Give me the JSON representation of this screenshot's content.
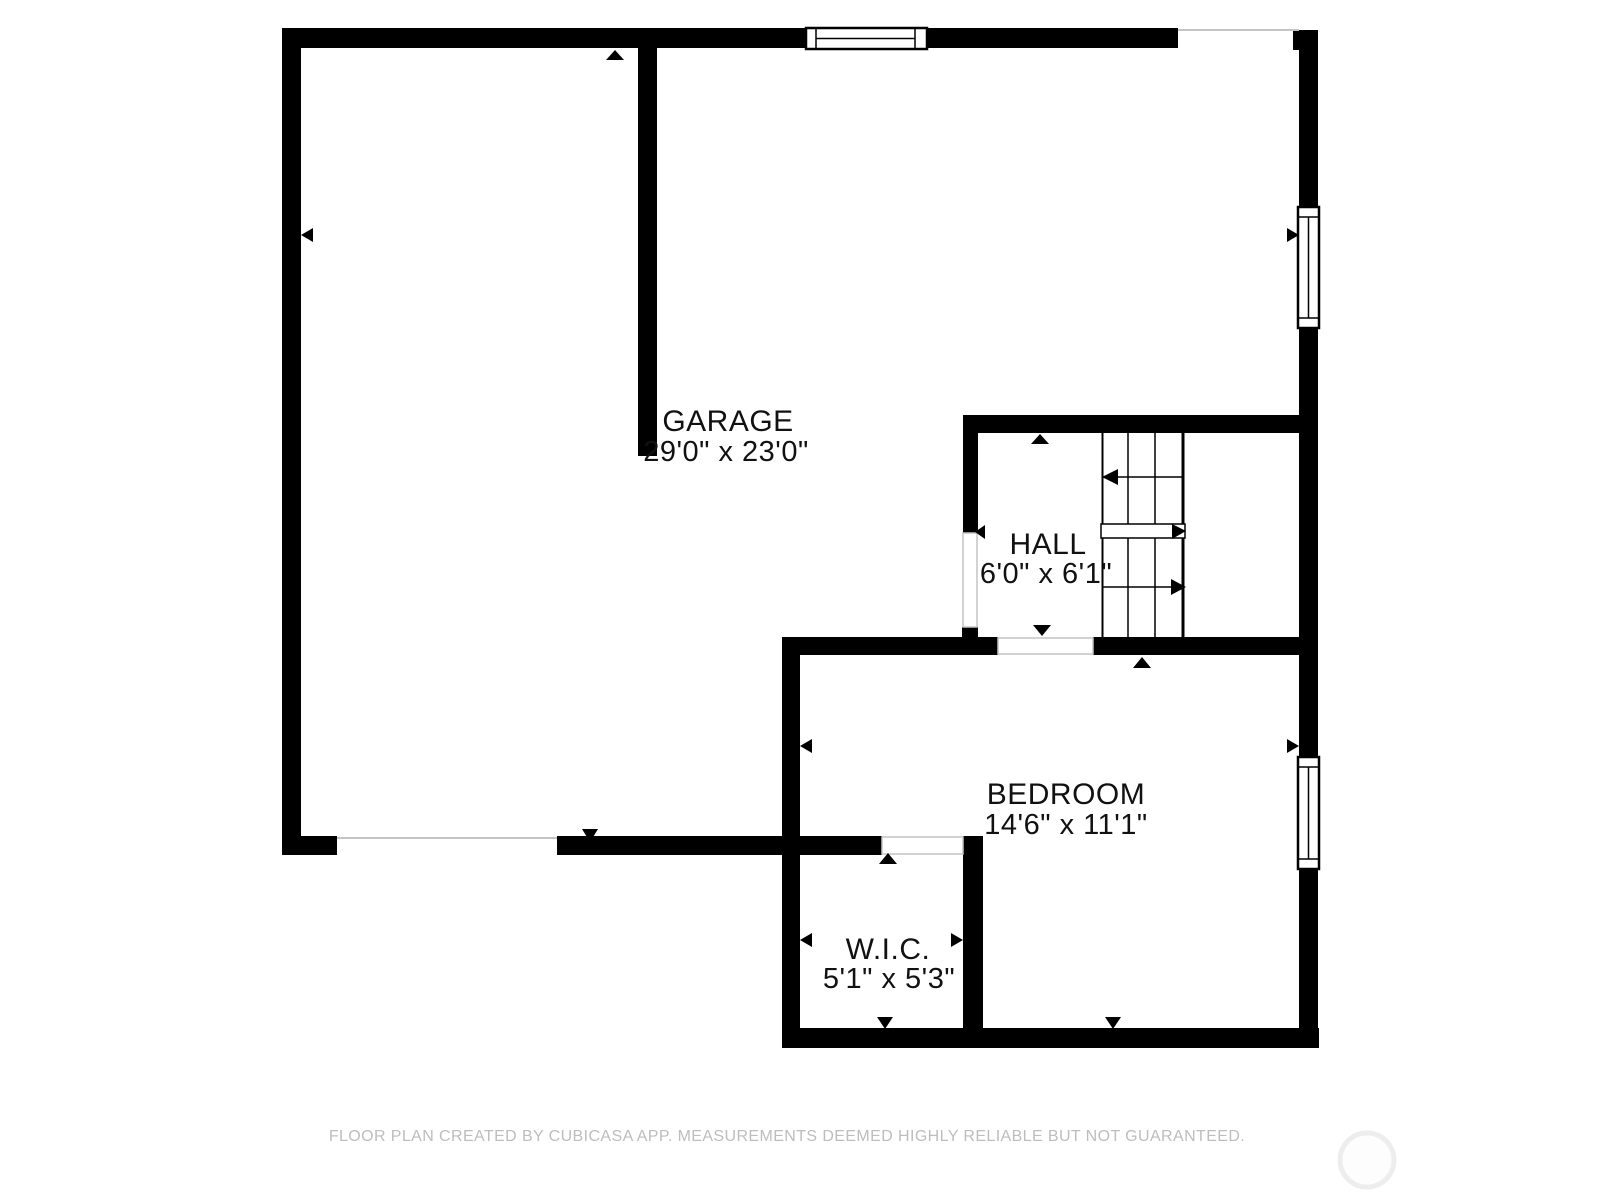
{
  "rooms": [
    {
      "name": "GARAGE",
      "dimensions": "29'0\" x 23'0\""
    },
    {
      "name": "HALL",
      "dimensions": "6'0\" x 6'1\""
    },
    {
      "name": "BEDROOM",
      "dimensions": "14'6\" x 11'1\""
    },
    {
      "name": "W.I.C.",
      "dimensions": "5'1\" x 5'3\""
    }
  ],
  "footer": {
    "disclaimer": "FLOOR PLAN CREATED BY CUBICASA APP. MEASUREMENTS DEEMED HIGHLY RELIABLE BUT NOT GUARANTEED."
  },
  "colors": {
    "wall": "#000000",
    "background": "#ffffff",
    "label_text": "#111111",
    "footer_text": "#bdbdbd",
    "opening_line": "#c4c4c4",
    "watermark_ring": "#ededed"
  }
}
